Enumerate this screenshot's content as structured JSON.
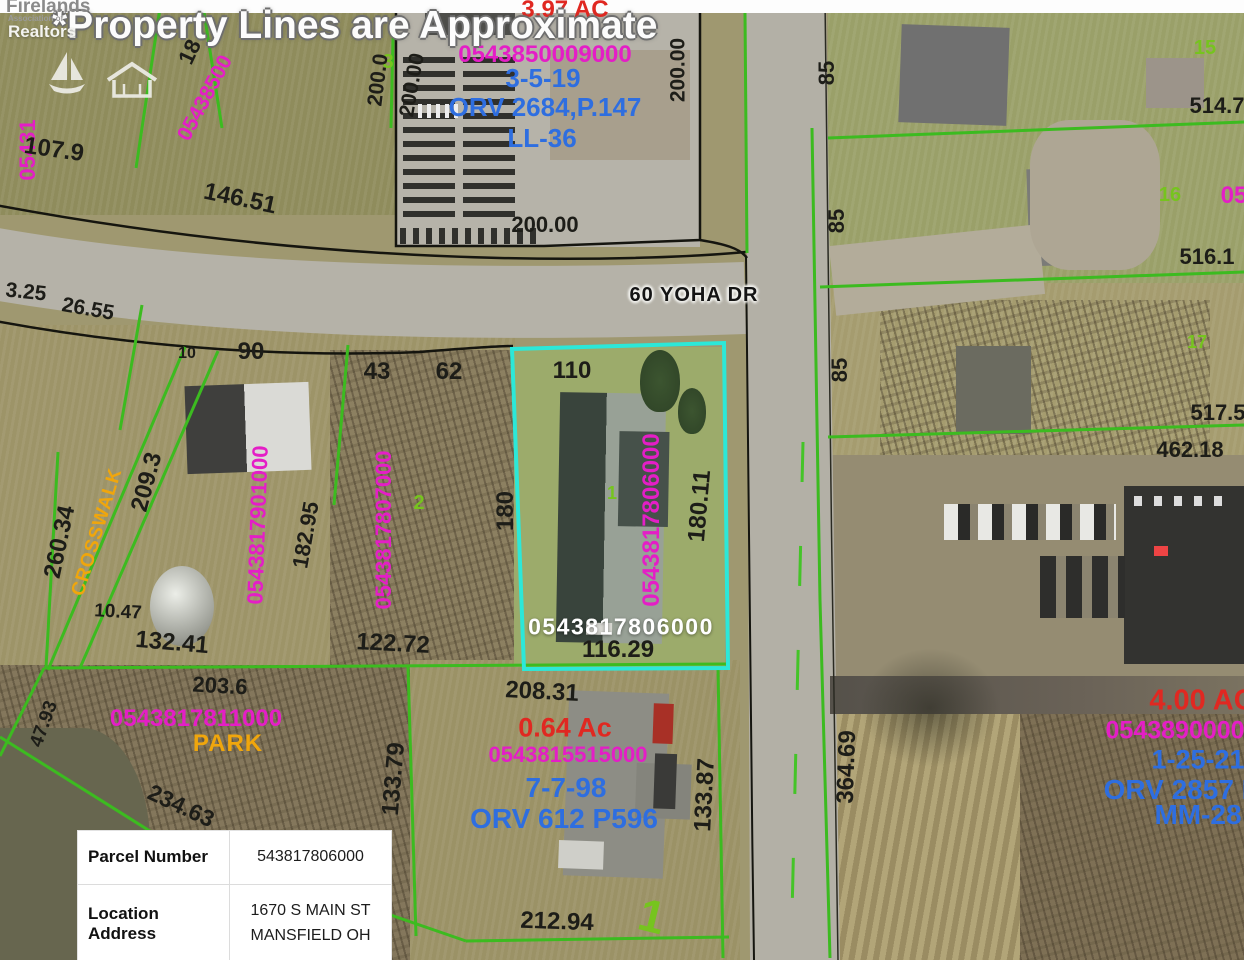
{
  "title": "*Property Lines are Approximate",
  "logo": {
    "name": "Firelands",
    "subtitle": "Association of",
    "realtors": "Realtors",
    "icons": [
      "sailboat-icon",
      "house-icon"
    ]
  },
  "colors": {
    "magenta_parcel": "#e41ec6",
    "blue_record": "#2e6ee0",
    "red_acreage": "#e02821",
    "green_line": "#3cbb20",
    "green_lot": "#76c41e",
    "orange_zone": "#f0a60c",
    "cyan_highlight": "#2ce8d8",
    "black_dimension": "#1d1d18"
  },
  "highlight_parcel": {
    "id": "0543817806000",
    "frontage": "116.29",
    "side": "180.11",
    "width_top": "110"
  },
  "info_table": {
    "rows": [
      {
        "label": "Parcel Number",
        "value": "543817806000"
      },
      {
        "label": "Location Address",
        "value": "1670 S MAIN ST\nMANSFIELD OH"
      }
    ]
  },
  "map_labels": [
    {
      "t": "05431",
      "x": 28,
      "y": 150,
      "r": -90,
      "c": "pid",
      "s": 22
    },
    {
      "t": "107.9",
      "x": 54,
      "y": 150,
      "r": 8,
      "c": "dim",
      "s": 24
    },
    {
      "t": "18",
      "x": 190,
      "y": 52,
      "r": -65,
      "c": "dim",
      "s": 22
    },
    {
      "t": "05438500",
      "x": 205,
      "y": 98,
      "r": -62,
      "c": "pid",
      "s": 21
    },
    {
      "t": "146.51",
      "x": 240,
      "y": 199,
      "r": 12,
      "c": "dim",
      "s": 24
    },
    {
      "t": "3",
      "x": 388,
      "y": 62,
      "r": 0,
      "c": "lot",
      "s": 20
    },
    {
      "t": "200.0",
      "x": 378,
      "y": 80,
      "r": -83,
      "c": "dim",
      "s": 21
    },
    {
      "t": "200.00",
      "x": 412,
      "y": 85,
      "r": -80,
      "c": "dim",
      "s": 21
    },
    {
      "t": "3.97 AC",
      "x": 565,
      "y": 10,
      "r": 0,
      "c": "ac",
      "s": 24
    },
    {
      "t": "0543850009000",
      "x": 545,
      "y": 55,
      "r": 0,
      "c": "pid",
      "s": 24
    },
    {
      "t": "3-5-19",
      "x": 543,
      "y": 78,
      "r": 0,
      "c": "rec",
      "s": 26
    },
    {
      "t": "ORV 2684,P.147",
      "x": 545,
      "y": 107,
      "r": 0,
      "c": "rec",
      "s": 26
    },
    {
      "t": "LL-36",
      "x": 542,
      "y": 138,
      "r": 0,
      "c": "rec",
      "s": 26
    },
    {
      "t": "200.00",
      "x": 678,
      "y": 70,
      "r": -90,
      "c": "dim",
      "s": 21
    },
    {
      "t": "200.00",
      "x": 545,
      "y": 225,
      "r": 0,
      "c": "dim",
      "s": 22
    },
    {
      "t": "60 YOHA DR",
      "x": 694,
      "y": 295,
      "r": 0,
      "c": "street",
      "s": 20
    },
    {
      "t": "85",
      "x": 827,
      "y": 73,
      "r": -90,
      "c": "dim",
      "s": 22
    },
    {
      "t": "15",
      "x": 1205,
      "y": 48,
      "r": 0,
      "c": "lot",
      "s": 20
    },
    {
      "t": "514.7",
      "x": 1217,
      "y": 106,
      "r": 0,
      "c": "dim",
      "s": 22
    },
    {
      "t": "85",
      "x": 837,
      "y": 221,
      "r": -90,
      "c": "dim",
      "s": 22
    },
    {
      "t": "16",
      "x": 1170,
      "y": 195,
      "r": 0,
      "c": "lot",
      "s": 20
    },
    {
      "t": "05",
      "x": 1234,
      "y": 196,
      "r": 0,
      "c": "pid",
      "s": 24
    },
    {
      "t": "516.1",
      "x": 1207,
      "y": 257,
      "r": 0,
      "c": "dim",
      "s": 22
    },
    {
      "t": "85",
      "x": 840,
      "y": 370,
      "r": -90,
      "c": "dim",
      "s": 22
    },
    {
      "t": "17",
      "x": 1197,
      "y": 342,
      "r": 0,
      "c": "lot",
      "s": 18
    },
    {
      "t": "517.5",
      "x": 1218,
      "y": 413,
      "r": 0,
      "c": "dim",
      "s": 22
    },
    {
      "t": "462.18",
      "x": 1190,
      "y": 450,
      "r": 0,
      "c": "dim",
      "s": 22
    },
    {
      "t": "3.25",
      "x": 26,
      "y": 292,
      "r": 6,
      "c": "dim",
      "s": 21
    },
    {
      "t": "26.55",
      "x": 88,
      "y": 309,
      "r": 10,
      "c": "dim",
      "s": 21
    },
    {
      "t": "10",
      "x": 187,
      "y": 354,
      "r": 0,
      "c": "dim",
      "s": 16
    },
    {
      "t": "90",
      "x": 251,
      "y": 352,
      "r": 0,
      "c": "dim",
      "s": 24
    },
    {
      "t": "43",
      "x": 377,
      "y": 372,
      "r": 0,
      "c": "dim",
      "s": 24
    },
    {
      "t": "62",
      "x": 449,
      "y": 372,
      "r": 0,
      "c": "dim",
      "s": 24
    },
    {
      "t": "110",
      "x": 572,
      "y": 371,
      "r": 0,
      "c": "dim",
      "s": 24
    },
    {
      "t": "CROSSWALK",
      "x": 97,
      "y": 532,
      "r": -73,
      "c": "zone",
      "s": 19
    },
    {
      "t": "260.34",
      "x": 60,
      "y": 542,
      "r": -78,
      "c": "dim",
      "s": 24
    },
    {
      "t": "209.3",
      "x": 147,
      "y": 482,
      "r": -75,
      "c": "dim",
      "s": 24
    },
    {
      "t": "0543817901000",
      "x": 258,
      "y": 525,
      "r": -88,
      "c": "pid",
      "s": 22
    },
    {
      "t": "182.95",
      "x": 306,
      "y": 535,
      "r": -80,
      "c": "dim",
      "s": 22
    },
    {
      "t": "0543817807000",
      "x": 384,
      "y": 530,
      "r": -90,
      "c": "pid",
      "s": 22
    },
    {
      "t": "2",
      "x": 419,
      "y": 503,
      "r": 0,
      "c": "lot",
      "s": 20
    },
    {
      "t": "180",
      "x": 506,
      "y": 511,
      "r": -90,
      "c": "dim",
      "s": 24
    },
    {
      "t": "10.47",
      "x": 118,
      "y": 612,
      "r": 3,
      "c": "dim",
      "s": 19
    },
    {
      "t": "132.41",
      "x": 172,
      "y": 643,
      "r": 5,
      "c": "dim",
      "s": 24
    },
    {
      "t": "122.72",
      "x": 393,
      "y": 644,
      "r": 3,
      "c": "dim",
      "s": 24
    },
    {
      "t": "0543817806000",
      "x": 652,
      "y": 520,
      "r": -90,
      "c": "pid",
      "s": 24
    },
    {
      "t": "180.11",
      "x": 700,
      "y": 506,
      "r": -85,
      "c": "dim",
      "s": 24
    },
    {
      "t": "1",
      "x": 612,
      "y": 493,
      "r": 0,
      "c": "lot",
      "s": 18
    },
    {
      "t": "0543817806000",
      "x": 621,
      "y": 627,
      "r": 0,
      "c": "whiteid",
      "s": 23
    },
    {
      "t": "116.29",
      "x": 618,
      "y": 650,
      "r": 0,
      "c": "dim",
      "s": 24
    },
    {
      "t": "208.31",
      "x": 542,
      "y": 692,
      "r": 3,
      "c": "dim",
      "s": 24
    },
    {
      "t": "0.64 Ac",
      "x": 565,
      "y": 728,
      "r": 0,
      "c": "ac",
      "s": 27
    },
    {
      "t": "0543815515000",
      "x": 568,
      "y": 755,
      "r": 0,
      "c": "pid",
      "s": 22
    },
    {
      "t": "7-7-98",
      "x": 566,
      "y": 788,
      "r": 0,
      "c": "rec",
      "s": 28
    },
    {
      "t": "ORV 612 P596",
      "x": 564,
      "y": 819,
      "r": 0,
      "c": "rec",
      "s": 28
    },
    {
      "t": "133.87",
      "x": 705,
      "y": 795,
      "r": -87,
      "c": "dim",
      "s": 24
    },
    {
      "t": "133.79",
      "x": 394,
      "y": 779,
      "r": -85,
      "c": "dim",
      "s": 24
    },
    {
      "t": "212.94",
      "x": 557,
      "y": 922,
      "r": 2,
      "c": "dim",
      "s": 24
    },
    {
      "t": "1",
      "x": 652,
      "y": 916,
      "r": 14,
      "c": "lot",
      "s": 46
    },
    {
      "t": "203.6",
      "x": 220,
      "y": 686,
      "r": 3,
      "c": "dim",
      "s": 22
    },
    {
      "t": "0543817811000",
      "x": 196,
      "y": 719,
      "r": 0,
      "c": "pid",
      "s": 24
    },
    {
      "t": "PARK",
      "x": 228,
      "y": 744,
      "r": 0,
      "c": "zone",
      "s": 24
    },
    {
      "t": "47.93",
      "x": 44,
      "y": 724,
      "r": -70,
      "c": "dim",
      "s": 19
    },
    {
      "t": "234.63",
      "x": 181,
      "y": 806,
      "r": 25,
      "c": "dim",
      "s": 23
    },
    {
      "t": "364.69",
      "x": 847,
      "y": 767,
      "r": -88,
      "c": "dim",
      "s": 24
    },
    {
      "t": "4.00 AC",
      "x": 1202,
      "y": 701,
      "r": 0,
      "c": "ac",
      "s": 29
    },
    {
      "t": "05438900008",
      "x": 1182,
      "y": 731,
      "r": 0,
      "c": "pid",
      "s": 25
    },
    {
      "t": "1-25-21",
      "x": 1198,
      "y": 760,
      "r": 0,
      "c": "rec",
      "s": 27
    },
    {
      "t": "ORV 2857 P",
      "x": 1182,
      "y": 790,
      "r": 0,
      "c": "rec",
      "s": 28
    },
    {
      "t": "MM-28",
      "x": 1198,
      "y": 815,
      "r": 0,
      "c": "rec",
      "s": 28
    }
  ]
}
